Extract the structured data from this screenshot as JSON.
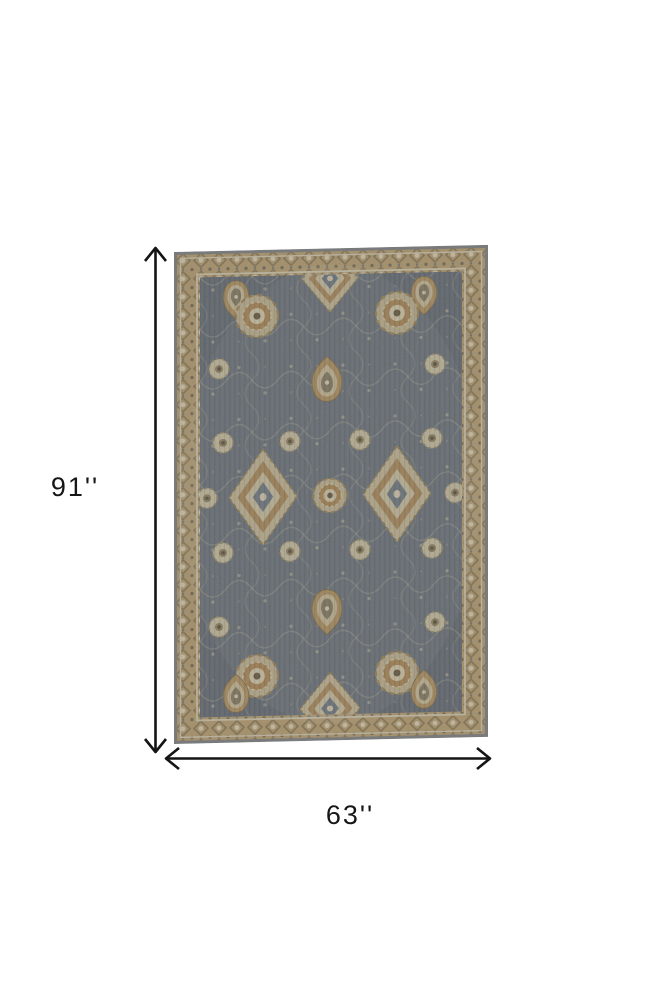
{
  "diagram": {
    "height_label": "91''",
    "width_label": "63''",
    "arrow_color": "#141414"
  },
  "rug": {
    "palette": {
      "edge": "#85888c",
      "border_tan": "#c3a878",
      "cream": "#d9cdab",
      "tan": "#b7935f",
      "field": "#6a737d",
      "dark_brown": "#6d5f44"
    }
  }
}
